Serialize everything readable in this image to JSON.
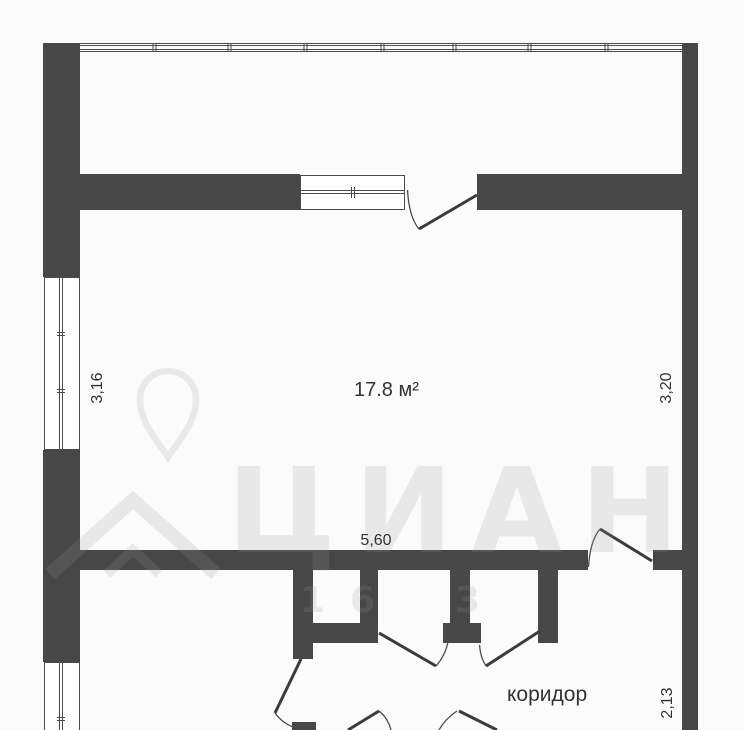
{
  "plan": {
    "room": {
      "area_label": "17.8 м²"
    },
    "corridor": {
      "label": "коридор"
    },
    "dimensions": {
      "left": "3,16",
      "right_upper": "3,20",
      "bottom_width": "5,60",
      "right_lower": "2,13"
    }
  },
  "watermark": {
    "brand": "ЦИАН",
    "digits": [
      "1",
      "6",
      "3"
    ]
  },
  "colors": {
    "wall": "#474747",
    "line": "#4c4c4c",
    "leaf": "#3b3b3b",
    "text": "#333333",
    "bg": "#fbfbfb",
    "wm": "rgba(150,150,150,0.18)"
  }
}
